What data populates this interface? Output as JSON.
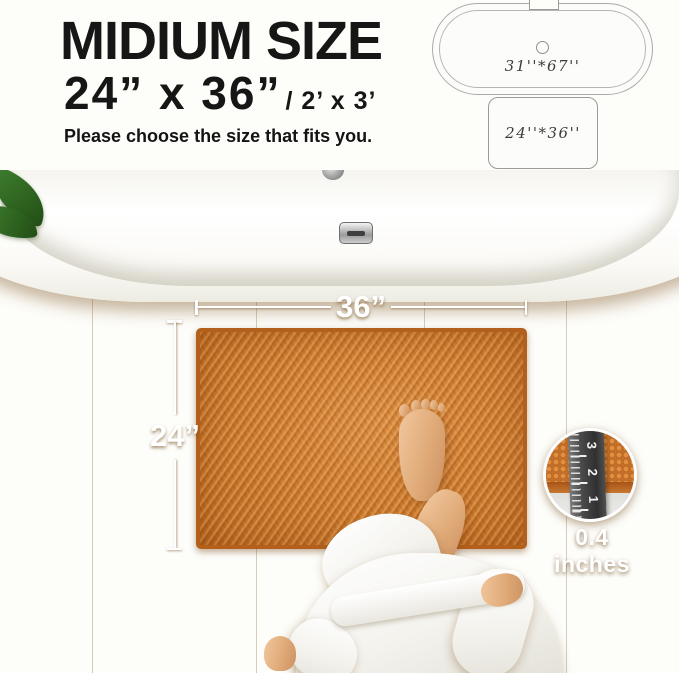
{
  "header": {
    "title": "MIDIUM SIZE",
    "size_primary": "24”  x 36”",
    "size_secondary": "/ 2’ x 3’",
    "subtitle": "Please choose the size that fits you."
  },
  "size_diagram": {
    "bathtub_dimensions": "31''*67''",
    "mat_dimensions": "24''*36''"
  },
  "scene": {
    "mat_width_label": "36”",
    "mat_height_label": "24”",
    "thickness_label": "0.4 inches",
    "ruler_numbers": [
      "1",
      "2",
      "3"
    ]
  },
  "colors": {
    "mat_orange": "#c9782e",
    "mat_border": "#b2601b",
    "floor_wood": "#ddb780",
    "leaf_green": "#2f6d22",
    "annotation_white": "#ffffff",
    "title_black": "#161616"
  }
}
